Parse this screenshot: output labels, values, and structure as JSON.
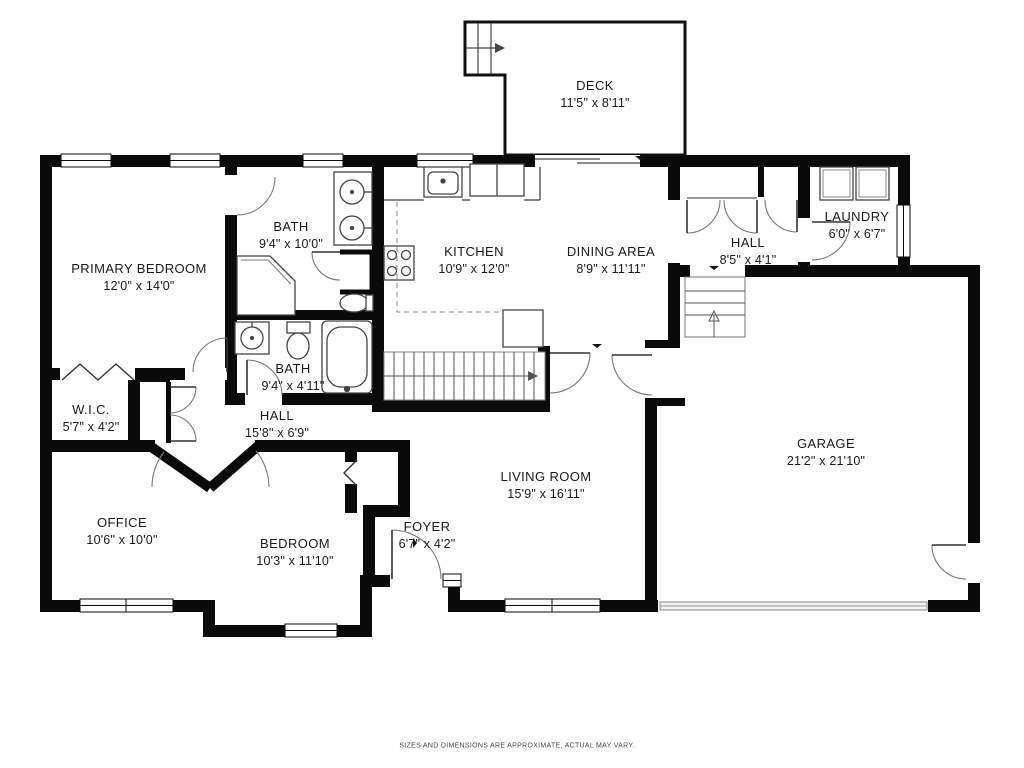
{
  "plan": {
    "title": "Floor plan",
    "disclaimer": "SIZES AND DIMENSIONS ARE APPROXIMATE, ACTUAL MAY VARY.",
    "colors": {
      "wall": "#0a0a0a",
      "background": "#ffffff",
      "fixture_line": "#555555",
      "door_arc": "#777777",
      "garage_door": "#999999"
    },
    "rooms": [
      {
        "id": "deck",
        "name": "DECK",
        "dims": "11'5\" x 8'11\""
      },
      {
        "id": "primary-bedroom",
        "name": "PRIMARY BEDROOM",
        "dims": "12'0\" x 14'0\""
      },
      {
        "id": "bath-upper",
        "name": "BATH",
        "dims": "9'4\" x 10'0\""
      },
      {
        "id": "kitchen",
        "name": "KITCHEN",
        "dims": "10'9\" x 12'0\""
      },
      {
        "id": "dining-area",
        "name": "DINING AREA",
        "dims": "8'9\" x 11'11\""
      },
      {
        "id": "hall-upper",
        "name": "HALL",
        "dims": "8'5\" x 4'1\""
      },
      {
        "id": "laundry",
        "name": "LAUNDRY",
        "dims": "6'0\" x 6'7\""
      },
      {
        "id": "garage",
        "name": "GARAGE",
        "dims": "21'2\" x 21'10\""
      },
      {
        "id": "bath-lower",
        "name": "BATH",
        "dims": "9'4\" x 4'11\""
      },
      {
        "id": "wic",
        "name": "W.I.C.",
        "dims": "5'7\" x 4'2\""
      },
      {
        "id": "hall-main",
        "name": "HALL",
        "dims": "15'8\" x 6'9\""
      },
      {
        "id": "office",
        "name": "OFFICE",
        "dims": "10'6\" x 10'0\""
      },
      {
        "id": "bedroom",
        "name": "BEDROOM",
        "dims": "10'3\" x 11'10\""
      },
      {
        "id": "foyer",
        "name": "FOYER",
        "dims": "6'7\" x 4'2\""
      },
      {
        "id": "living-room",
        "name": "LIVING ROOM",
        "dims": "15'9\" x 16'11\""
      }
    ]
  }
}
